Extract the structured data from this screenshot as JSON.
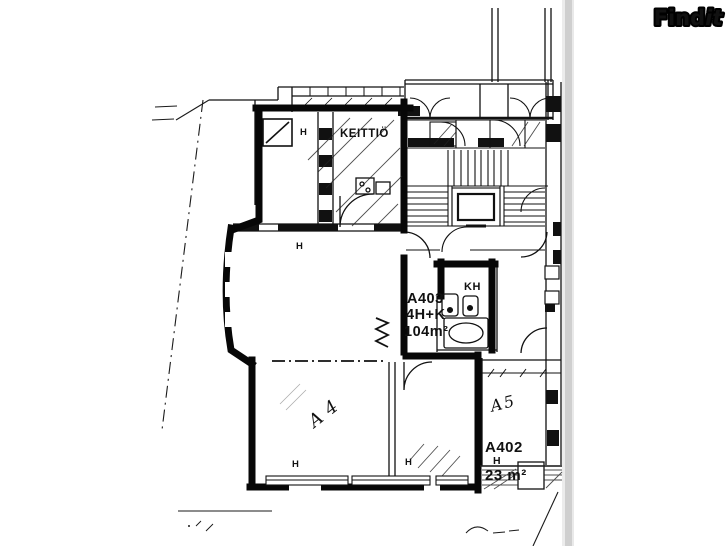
{
  "watermark": {
    "brand_regular": "Find",
    "brand_italic": "it"
  },
  "floor_plan": {
    "kitchen_label": "KEITTIÖ",
    "room_marker": "H",
    "bathroom_label": "KH",
    "apartment": {
      "id": "A403",
      "rooms": "4H+K",
      "area": "104m²"
    },
    "neighbor": {
      "id": "A402",
      "marker": "H",
      "area": "23 m²"
    },
    "handwritten": {
      "left_room": "A4",
      "right_room": "A5"
    }
  },
  "colors": {
    "ink": "#111111",
    "paper": "#ffffff",
    "scan_bar": "#cfcfcf"
  }
}
